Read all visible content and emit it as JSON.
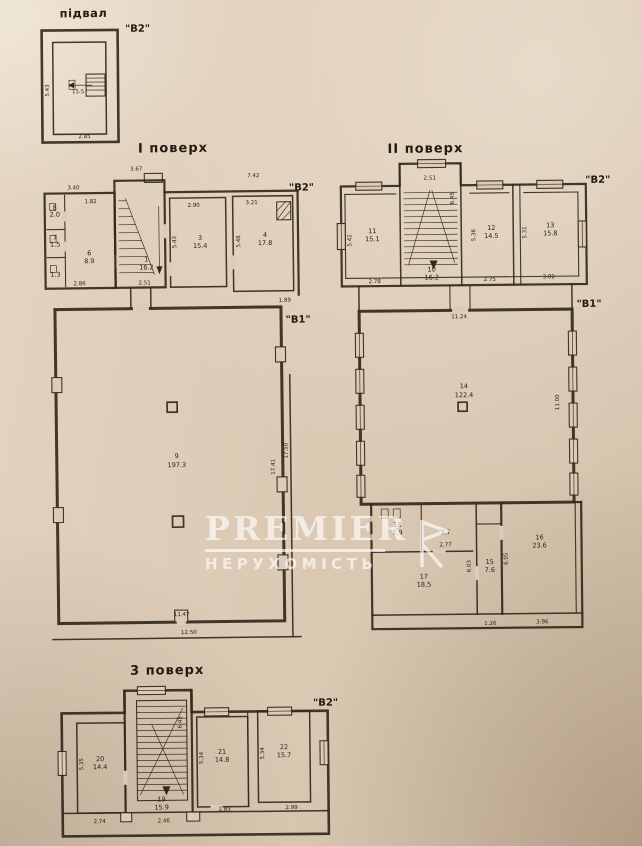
{
  "colors": {
    "paper": "#dccbb6",
    "ink": "#32281c",
    "watermark": "#ffffff"
  },
  "watermark": {
    "brand": "PREMIER",
    "subtitle": "НЕРУХОМІСТЬ"
  },
  "basement": {
    "title": "підвал",
    "block": "\"В2\"",
    "area": "15.5",
    "dim_left": "5.43",
    "dim_bottom": "2.85"
  },
  "floor1": {
    "title": "І поверх",
    "block_v2": "\"В2\"",
    "block_v1": "\"В1\"",
    "dim_annex_top": "3.40",
    "dim_annex_top2": "1.82",
    "dim_annex_bottom": "2.86",
    "room8_num": "8",
    "room8_area": "2.0",
    "room7_num": "7",
    "room7_area": "1.5",
    "cell_area": "1.3",
    "room6_num": "6",
    "room6_area": "8.9",
    "room1_num": "1",
    "room1_area": "16.2",
    "dim_stair_top": "3.67",
    "dim_stair_bottom": "2.51",
    "room3_num": "3",
    "room3_area": "15.4",
    "dim_room3_top": "2.90",
    "dim_room3_left": "5.43",
    "room4_num": "4",
    "room4_area": "17.8",
    "dim_room4_top": "7.42",
    "dim_room4_top2": "3.21",
    "dim_room4_left": "5.48",
    "room9_num": "9",
    "room9_area": "197.3",
    "dim_hall_right": "17.41",
    "dim_hall_right2": "17.50",
    "dim_hall_bottom": "11.47",
    "dim_hall_bottom2": "12.50",
    "dim_hall_topright": "1.89"
  },
  "floor2": {
    "title": "ІІ поверх",
    "block_v2": "\"В2\"",
    "block_v1": "\"В1\"",
    "room11_num": "11",
    "room11_area": "15.1",
    "dim_room11_bottom": "2.78",
    "dim_room11_left": "5.42",
    "room10_num": "10",
    "room10_area": "16.2",
    "dim_room10_top": "2.51",
    "dim_room10_right": "6.45",
    "room12_num": "12",
    "room12_area": "14.5",
    "dim_room12_bottom": "2.75",
    "dim_room12_left": "5.36",
    "room13_num": "13",
    "room13_area": "15.8",
    "dim_room13_bottom": "3.02",
    "dim_room13_left": "5.31",
    "room14_num": "14",
    "room14_area": "122.4",
    "dim_room14_top": "11.24",
    "dim_room14_right": "11.00",
    "room18_num": "18",
    "room18_area": "7.9",
    "closet_area": "3.7",
    "dim_closet": "2.77",
    "room15_num": "15",
    "room15_area": "7.6",
    "dim_room15_left": "6.03",
    "dim_room15_right": "6.05",
    "dim_room15_bottom": "1.26",
    "room16_num": "16",
    "room16_area": "23.6",
    "dim_room16_bottom": "3.96",
    "room17_num": "17",
    "room17_area": "18.5"
  },
  "floor3": {
    "title": "3 поверх",
    "block_v2": "\"В2\"",
    "room20_num": "20",
    "room20_area": "14.4",
    "dim_room20_left": "5.35",
    "dim_room20_bottom": "2.74",
    "room19_num": "19",
    "room19_area": "15.9",
    "dim_room19_right": "6.45",
    "dim_room19_bottom": "2.46",
    "room21_num": "21",
    "room21_area": "14.8",
    "dim_room21_left": "5.34",
    "dim_room21_bottom": "2.83",
    "room22_num": "22",
    "room22_area": "15.7",
    "dim_room22_left": "5.34",
    "dim_room22_bottom": "2.99"
  }
}
